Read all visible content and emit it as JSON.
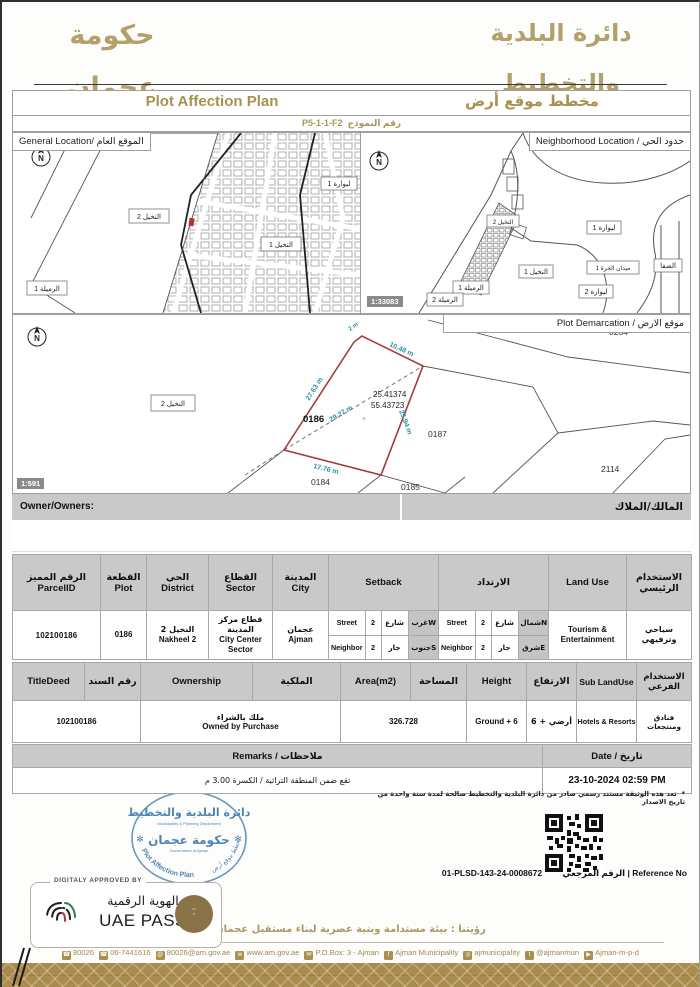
{
  "colors": {
    "accent_gold": "#a8914f",
    "band_gold": "#a98c4d",
    "stamp_blue": "#4d85b5",
    "plot_outline_red": "#a23d3a",
    "dimension_teal": "#2e8fa5",
    "table_header_gray": "#c9c9c9"
  },
  "header": {
    "gov_logo_ar": "حكومة عجمان",
    "gov_logo_caption": "Government Of Ajman",
    "dept_logo_ar": "دائرة البلدية والتخطيط",
    "dept_logo_caption": "Municipality & Planning Department"
  },
  "title_bar": {
    "en": "Plot Affection Plan",
    "ar": "مخطط موقع أرض",
    "form_no_label": "رقم النموذج",
    "form_no": "P5-1-1-F2"
  },
  "maps": {
    "general": {
      "title": "General Location/ الموقع العام",
      "l_nakheel2": "النخيل 2",
      "l_nakheel1": "النخيل 1",
      "l_liwara1": "ليوارة 1",
      "l_rumaila1": "الرميلة 1"
    },
    "shared_scale": "1:33083",
    "neighborhood": {
      "title": "Neighborhood Location / حدود الحي",
      "l_nakheel2": "النخيل 2",
      "l_nakheel1": "النخيل 1",
      "l_liwara1": "ليوارة 1",
      "l_liwara2": "ليوارة 2",
      "l_rumaila1": "الرميلة 1",
      "l_rumaila2": "الرميلة 2",
      "l_maydan": "ميدان الحرة 1",
      "l_safa": "الصفا"
    },
    "demarcation": {
      "title": "Plot Demarcation / موقع الارض",
      "scale": "1:591",
      "plot_no": "0186",
      "lat": "25.41374",
      "lng": "55.43723",
      "dim_top": "10.48 m",
      "dim_left": "27.63 m",
      "dim_right": "25.94 m",
      "dim_bottom": "17.76 m",
      "dim_diag": "29.27 m",
      "dim_corner": "2 m",
      "n_0234": "0234",
      "n_0187": "0187",
      "n_2114": "2114",
      "n_0184": "0184",
      "n_0185": "0185",
      "district_box": "النخيل 2"
    }
  },
  "owner": {
    "label_en": "Owner/Owners:",
    "label_ar": "المالك/الملاك"
  },
  "table1": {
    "h_parcel_ar": "الرقم المميز",
    "h_parcel_en": "ParcelID",
    "h_plot_ar": "القطعة",
    "h_plot_en": "Plot",
    "h_district_ar": "الحي",
    "h_district_en": "District",
    "h_sector_ar": "القطاع",
    "h_sector_en": "Sector",
    "h_city_ar": "المدينة",
    "h_city_en": "City",
    "h_setback": "Setback",
    "h_irtidad": "الارتداد",
    "h_landuse_en": "Land Use",
    "h_landuse_ar": "الاستخدام الرئيسي",
    "parcel_id": "102100186",
    "plot": "0186",
    "district_ar": "النخيل 2",
    "district_en": "Nakheel 2",
    "sector_ar": "قطاع مركز المدينة",
    "sector_en": "City Center Sector",
    "city_ar": "عجمان",
    "city_en": "Ajman",
    "setback_rows": [
      {
        "en": "Street",
        "val": "2",
        "ar": "شارع",
        "dir": "غربW"
      },
      {
        "en": "Neighbor",
        "val": "2",
        "ar": "جار",
        "dir": "جنوبS"
      }
    ],
    "irtidad_rows": [
      {
        "en": "Street",
        "val": "2",
        "ar": "شارع",
        "dir": "شمالN"
      },
      {
        "en": "Neighbor",
        "val": "2",
        "ar": "جار",
        "dir": "شرقE"
      }
    ],
    "landuse_en": "Tourism & Entertainment",
    "landuse_ar": "سياحي وترفيهي"
  },
  "table2": {
    "h_titledeed": "TitleDeed",
    "h_sanad_ar": "رقم السند",
    "h_ownership": "Ownership",
    "h_milkia_ar": "الملكية",
    "h_area": "Area(m2)",
    "h_area_ar": "المساحة",
    "h_height": "Height",
    "h_height_ar": "الارتفاع",
    "h_sublanduse": "Sub LandUse",
    "h_sublanduse_ar": "الاستخدام الفرعي",
    "titledeed": "102100186",
    "ownership_ar": "ملك بالشراء",
    "ownership_en": "Owned by Purchase",
    "area": "326.728",
    "height_en": "Ground + 6",
    "height_ar": "أرضي + 6",
    "sublanduse_en": "Hotels & Resorts",
    "sublanduse_ar": "فنادق ومنتجعات"
  },
  "remarks_row": {
    "h_remarks": "Remarks / ملاحظات",
    "h_date": "Date / تاريخ",
    "remarks": "تقع ضمن المنطقة التراثية / الكسرة 3.00 م",
    "date": "23-10-2024 02:59 PM"
  },
  "footnote": {
    "bullet": "*",
    "text": "تعد هذه الوثيقة مستند رسمي صادر من دائرة البلدية والتخطيط صالحة لمدة سنة واحدة من تاريخ الاصدار"
  },
  "stamp": {
    "dept_ar": "دائرة البلدية والتخطيط",
    "dept_en": "Municipality & Planning Department",
    "gov_ar": "حكومة عجمان",
    "gov_en": "Government of Ajman",
    "arc_ar": "مخطط موقع أرض",
    "arc_en": "Plot Affection Plan"
  },
  "reference": {
    "value": "01-PLSD-143-24-0008672",
    "label": "Reference No | الرقم المرجعي"
  },
  "uae_pass": {
    "approved": "DIGITALY APPROVED BY",
    "title_ar": "الهوية الرقمية",
    "title_en": "UAE PASS"
  },
  "vision": "رؤيتنا : بيئة مستدامة وبنية عصرية لبناء مستقبل عجمان",
  "contact": {
    "items": [
      {
        "icon": "phone-icon",
        "glyph": "☎",
        "label": "80026"
      },
      {
        "icon": "fax-icon",
        "glyph": "☎",
        "label": "06-7441616"
      },
      {
        "icon": "email-icon",
        "glyph": "@",
        "label": "80026@am.gov.ae"
      },
      {
        "icon": "web-icon",
        "glyph": "w",
        "label": "www.am.gov.ae"
      },
      {
        "icon": "pobox-icon",
        "glyph": "✉",
        "label": "P.O.Box: 3 - Ajman"
      },
      {
        "icon": "facebook-icon",
        "glyph": "f",
        "label": "Ajman Municipality"
      },
      {
        "icon": "instagram-icon",
        "glyph": "◎",
        "label": "ajmunicipality"
      },
      {
        "icon": "twitter-icon",
        "glyph": "t",
        "label": "@ajmanmun"
      },
      {
        "icon": "youtube-icon",
        "glyph": "▶",
        "label": "Ajman-m-p-d"
      }
    ]
  }
}
